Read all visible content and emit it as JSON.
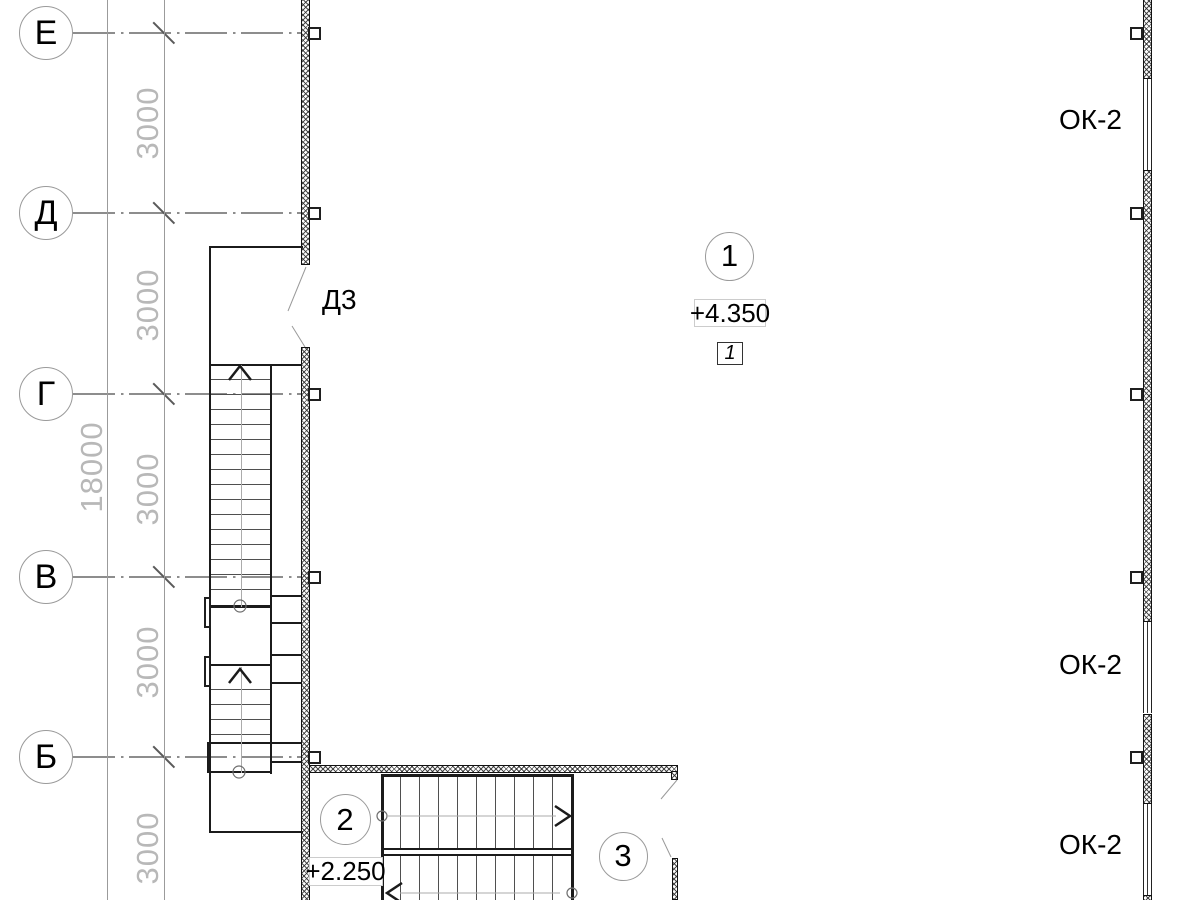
{
  "drawing": {
    "axis_labels": [
      "Е",
      "Д",
      "Г",
      "В",
      "Б"
    ],
    "dim_overall": "18000",
    "dim_segment": "3000",
    "door_label": "Д3",
    "window_label": "ОК-2",
    "grid_marker": "1",
    "elevation_upper": "+4.350",
    "section_flag": "1",
    "node_marker_2": "2",
    "elevation_lower": "+2.250",
    "node_marker_3": "3"
  },
  "colors": {
    "line_dark": "#1b1b1b",
    "line_axis": "#8d8d8d",
    "dim_text": "#b8b8b8",
    "leader": "#9a9a9a",
    "background": "#ffffff"
  },
  "geometry": {
    "axes_y": [
      33,
      213,
      394,
      577,
      757
    ],
    "axis_circle": {
      "cx": 46,
      "r": 27,
      "line_x1": 73,
      "line_x2": 301
    },
    "dim_lines_x": [
      107,
      164
    ],
    "slash_cx": 164,
    "dim3000": {
      "x": 148,
      "ys": [
        123,
        305,
        489,
        662,
        848
      ]
    },
    "dim18000": {
      "x": 92,
      "y": 467
    },
    "left_wall": {
      "x": 301,
      "w": 8.5,
      "segments": [
        [
          0,
          265
        ],
        [
          347,
          900
        ]
      ],
      "tick_x": 308
    },
    "right_wall": {
      "x": 1143,
      "w": 8.5,
      "segments": [
        [
          0,
          79
        ],
        [
          170,
          622
        ],
        [
          714,
          804
        ],
        [
          895,
          900
        ]
      ],
      "windows": [
        [
          79,
          170
        ],
        [
          622,
          713
        ],
        [
          804,
          895
        ]
      ],
      "tick_x": 1130
    },
    "ok2_labels": {
      "x": 1059,
      "ys": [
        121,
        666,
        846
      ]
    },
    "v_treads": {
      "x": 211,
      "w": 59,
      "flight1": {
        "from": 379,
        "to": 592,
        "step": 15
      },
      "flight2": {
        "from": 689,
        "to": 737,
        "step": 15
      }
    },
    "h_treads": {
      "y1": 777,
      "h1": 71,
      "y2": 856,
      "h2": 44,
      "xs": {
        "from": 400,
        "to": 553,
        "step": 19
      }
    },
    "shapes": [
      [
        "thick",
        208.5,
        246,
        94,
        2,
        "room-outline-top"
      ],
      [
        "thick",
        208.5,
        246,
        2.5,
        587,
        "room-outline-left"
      ],
      [
        "thick",
        208.5,
        831,
        94,
        2,
        "room-outline-bottom"
      ],
      [
        "thick",
        208.5,
        363.5,
        93,
        2.5,
        "stair-top-edge"
      ],
      [
        "thick",
        269.5,
        363.5,
        2.5,
        410,
        "stair-right-edge"
      ],
      [
        "thick",
        209,
        605,
        62,
        2.5,
        "landing-top-edge"
      ],
      [
        "thick",
        209,
        663.5,
        62,
        2.5,
        "landing-bottom-edge"
      ],
      [
        "landing",
        206.5,
        741.5,
        65,
        31,
        "stair-bottom-landing"
      ],
      [
        "thick",
        271,
        594.5,
        30,
        2,
        "shaft-divider"
      ],
      [
        "thick",
        271,
        622,
        30,
        1.5,
        "shaft-divider"
      ],
      [
        "thick",
        271,
        654,
        30,
        1.5,
        "shaft-divider"
      ],
      [
        "thick",
        271,
        682,
        30,
        2,
        "shaft-divider"
      ],
      [
        "thick",
        271,
        742,
        30,
        1.5,
        "shaft-divider"
      ],
      [
        "thick",
        271,
        761,
        30,
        1.5,
        "shaft-divider"
      ],
      [
        "pilaster",
        203.5,
        596.5,
        7.5,
        31,
        "door-jamb"
      ],
      [
        "pilaster",
        203.5,
        655.5,
        7.5,
        31,
        "door-jamb"
      ],
      [
        "wallh hatch",
        310,
        764.5,
        368,
        8,
        "corridor-wall"
      ],
      [
        "wallv hatch",
        671,
        771,
        7,
        9,
        "corridor-wall-end"
      ],
      [
        "wallv hatch",
        671.5,
        858,
        6.5,
        42,
        "partition-wall"
      ],
      [
        "thick",
        381,
        774,
        192.5,
        2.5,
        "hstair-top-edge"
      ],
      [
        "thick",
        381,
        774,
        2.5,
        126,
        "hstair-left-edge"
      ],
      [
        "thick",
        571,
        774,
        2.5,
        126,
        "hstair-right-edge"
      ],
      [
        "thick",
        381,
        847.5,
        192.5,
        2,
        "hstair-mid-line"
      ],
      [
        "thick",
        381,
        853.5,
        192.5,
        2,
        "hstair-mid-line"
      ],
      [
        "grayln",
        240.5,
        365,
        1,
        242,
        "flight-center-line"
      ],
      [
        "grayln",
        240.5,
        667,
        1,
        106,
        "flight-center-line"
      ]
    ]
  }
}
